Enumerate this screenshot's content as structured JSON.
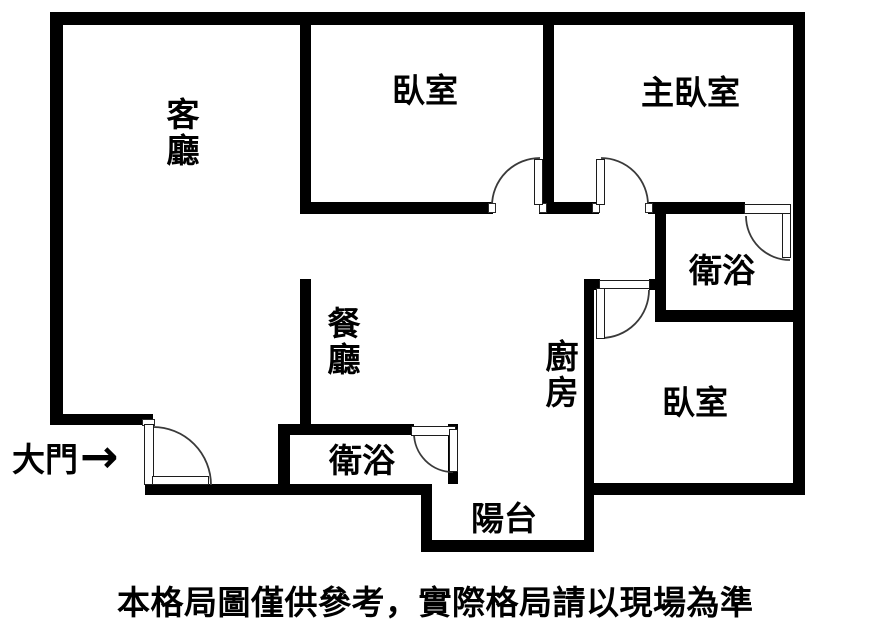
{
  "colors": {
    "wall": "#000000",
    "background": "#ffffff",
    "text": "#000000",
    "door_arc": "#3a3a3a"
  },
  "rooms": {
    "living": "客廳",
    "bedroom_top": "臥室",
    "master_bedroom": "主臥室",
    "bath_top": "衛浴",
    "dining": "餐廳",
    "kitchen": "廚房",
    "bedroom_bottom": "臥室",
    "bath_bottom": "衛浴",
    "balcony": "陽台"
  },
  "entrance": {
    "label": "大門",
    "arrow": "→"
  },
  "caption": "本格局圖僅供參考，實際格局請以現場為準"
}
